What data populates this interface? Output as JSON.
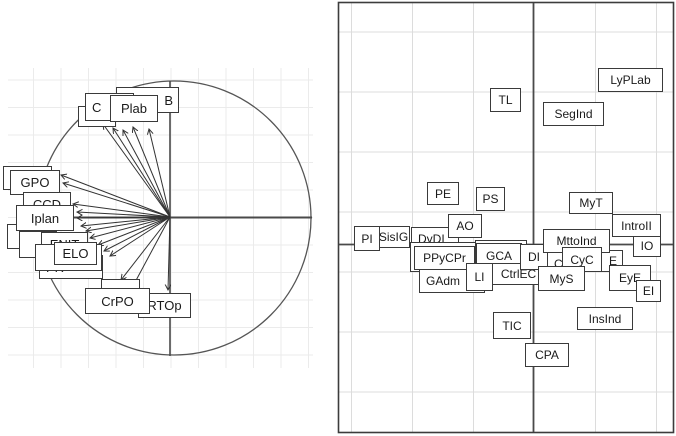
{
  "chart_data": {
    "type": "scatter",
    "title": "",
    "subtitle": "",
    "axes": {
      "tick_labels_visible": false,
      "xlabel": "",
      "ylabel": ""
    },
    "layout_hints": {
      "panel_count": 2,
      "left_panel": "correlation circle with arrows from origin to variable labels",
      "right_panel": "framed label map with center cross axes, light gridlines"
    },
    "colors": {
      "background": "#ffffff",
      "box_border": "#3a3a3a",
      "axis_line": "#4a4a4a",
      "arrow_line": "#333333",
      "grid_left": "#ebebeb",
      "grid_right": "#dcdcdc",
      "frame": "#3c3c3c",
      "text": "#1a1a1a"
    },
    "panels": [
      {
        "name": "variables-correlation-circle",
        "origin": [
          170,
          217
        ],
        "circle": {
          "cx": 174,
          "cy": 218,
          "r": 137
        },
        "arrows": [
          [
            103,
            124
          ],
          [
            113,
            128
          ],
          [
            123,
            130
          ],
          [
            133,
            127
          ],
          [
            149,
            129
          ],
          [
            61,
            175
          ],
          [
            63,
            183
          ],
          [
            73,
            204
          ],
          [
            77,
            212
          ],
          [
            77,
            218
          ],
          [
            81,
            226
          ],
          [
            86,
            231
          ],
          [
            90,
            238
          ],
          [
            98,
            245
          ],
          [
            104,
            251
          ],
          [
            110,
            256
          ],
          [
            121,
            280
          ],
          [
            133,
            286
          ],
          [
            168,
            290
          ]
        ],
        "labels": [
          {
            "text": "",
            "x": 78,
            "y": 106,
            "w": 38,
            "h": 21
          },
          {
            "text": "B",
            "x": 116,
            "y": 87,
            "w": 63,
            "h": 26,
            "align": "right"
          },
          {
            "text": "C",
            "x": 85,
            "y": 93,
            "w": 49,
            "h": 28,
            "align": "left"
          },
          {
            "text": "Plab",
            "x": 110,
            "y": 95,
            "w": 48,
            "h": 27
          },
          {
            "text": "",
            "x": 3,
            "y": 166,
            "w": 49,
            "h": 24
          },
          {
            "text": "GPO",
            "x": 10,
            "y": 170,
            "w": 50,
            "h": 25
          },
          {
            "text": "CCD",
            "x": 23,
            "y": 192,
            "w": 48,
            "h": 24
          },
          {
            "text": "",
            "x": 7,
            "y": 224,
            "w": 36,
            "h": 25
          },
          {
            "text": "Iplan",
            "x": 16,
            "y": 205,
            "w": 58,
            "h": 26
          },
          {
            "text": "",
            "x": 19,
            "y": 231,
            "w": 38,
            "h": 27
          },
          {
            "text": "ENIT",
            "x": 41,
            "y": 232,
            "w": 47,
            "h": 25
          },
          {
            "text": "PR",
            "x": 39,
            "y": 255,
            "w": 64,
            "h": 24,
            "align": "left"
          },
          {
            "text": "g",
            "x": 35,
            "y": 244,
            "w": 67,
            "h": 27,
            "align": "right"
          },
          {
            "text": "ELO",
            "x": 54,
            "y": 242,
            "w": 43,
            "h": 23
          },
          {
            "text": "e",
            "x": 101,
            "y": 279,
            "w": 39,
            "h": 25,
            "align": "right"
          },
          {
            "text": "RTOp",
            "x": 138,
            "y": 293,
            "w": 53,
            "h": 25
          },
          {
            "text": "CrPO",
            "x": 85,
            "y": 288,
            "w": 65,
            "h": 26
          }
        ]
      },
      {
        "name": "labels-map",
        "labels": [
          {
            "text": "SisIG",
            "x": 377,
            "y": 226,
            "w": 33,
            "h": 22
          },
          {
            "text": "DyDI",
            "x": 411,
            "y": 227,
            "w": 48,
            "h": 23,
            "align": "left"
          },
          {
            "text": "",
            "x": 410,
            "y": 242,
            "w": 70,
            "h": 30
          },
          {
            "text": "GAdm",
            "x": 419,
            "y": 269,
            "w": 66,
            "h": 24,
            "align": "left"
          },
          {
            "text": "PPyCPr",
            "x": 414,
            "y": 246,
            "w": 61,
            "h": 24
          },
          {
            "text": "",
            "x": 475,
            "y": 240,
            "w": 52,
            "h": 27
          },
          {
            "text": "GCA",
            "x": 476,
            "y": 243,
            "w": 46,
            "h": 25
          },
          {
            "text": "CtrlEC",
            "x": 492,
            "y": 263,
            "w": 53,
            "h": 22
          },
          {
            "text": "CL",
            "x": 547,
            "y": 252,
            "w": 24,
            "h": 24,
            "align": "left"
          },
          {
            "text": "E",
            "x": 597,
            "y": 250,
            "w": 26,
            "h": 22,
            "align": "right"
          },
          {
            "text": "DI",
            "x": 520,
            "y": 244,
            "w": 28,
            "h": 26
          },
          {
            "text": "MttoInd",
            "x": 543,
            "y": 229,
            "w": 67,
            "h": 24
          },
          {
            "text": "CyC",
            "x": 562,
            "y": 247,
            "w": 40,
            "h": 25
          },
          {
            "text": "MyS",
            "x": 538,
            "y": 266,
            "w": 47,
            "h": 25
          },
          {
            "text": "LI",
            "x": 466,
            "y": 263,
            "w": 27,
            "h": 28
          },
          {
            "text": "AO",
            "x": 448,
            "y": 214,
            "w": 34,
            "h": 24
          },
          {
            "text": "PI",
            "x": 354,
            "y": 226,
            "w": 26,
            "h": 25
          },
          {
            "text": "EyE",
            "x": 609,
            "y": 265,
            "w": 42,
            "h": 26
          },
          {
            "text": "EI",
            "x": 636,
            "y": 280,
            "w": 25,
            "h": 22
          },
          {
            "text": "IO",
            "x": 633,
            "y": 234,
            "w": 28,
            "h": 23
          },
          {
            "text": "IntroII",
            "x": 612,
            "y": 214,
            "w": 49,
            "h": 23
          },
          {
            "text": "MyT",
            "x": 569,
            "y": 192,
            "w": 44,
            "h": 22
          },
          {
            "text": "PE",
            "x": 427,
            "y": 182,
            "w": 32,
            "h": 23
          },
          {
            "text": "PS",
            "x": 476,
            "y": 187,
            "w": 29,
            "h": 24
          },
          {
            "text": "TL",
            "x": 490,
            "y": 88,
            "w": 31,
            "h": 24
          },
          {
            "text": "LyPLab",
            "x": 598,
            "y": 68,
            "w": 65,
            "h": 24
          },
          {
            "text": "SegInd",
            "x": 543,
            "y": 102,
            "w": 61,
            "h": 24
          },
          {
            "text": "TIC",
            "x": 493,
            "y": 312,
            "w": 38,
            "h": 27
          },
          {
            "text": "InsInd",
            "x": 577,
            "y": 307,
            "w": 56,
            "h": 23
          },
          {
            "text": "CPA",
            "x": 525,
            "y": 343,
            "w": 44,
            "h": 24
          }
        ]
      }
    ]
  }
}
